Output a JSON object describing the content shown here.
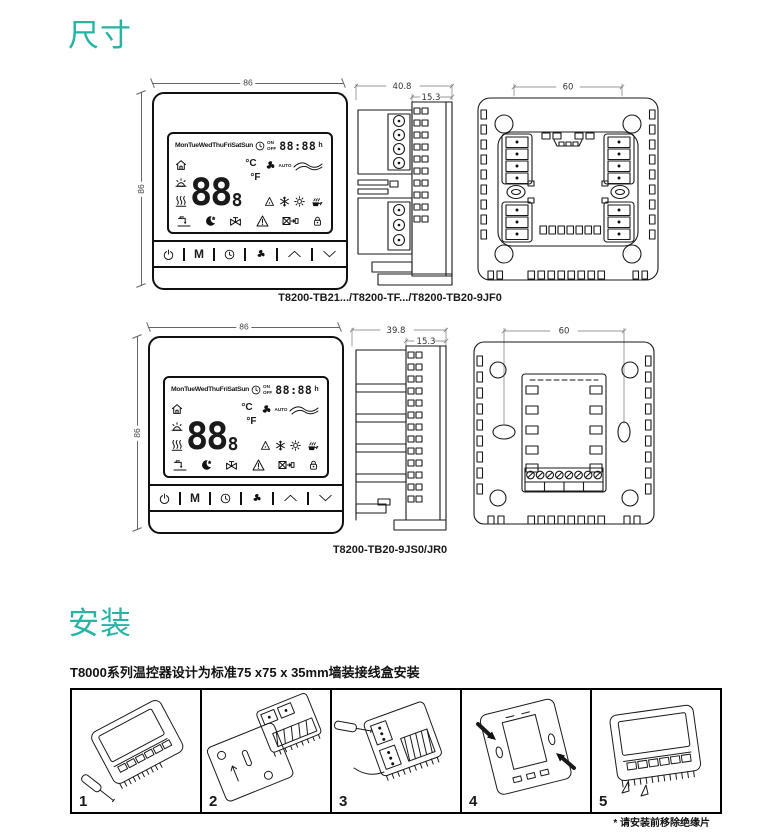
{
  "accent_color": "#26b5a3",
  "dimensions_section": {
    "title": "尺寸",
    "front_width_label": "86",
    "front_height_label": "86",
    "row1": {
      "side_depth": "40.8",
      "side_front_depth": "15.3",
      "back_hole_spacing": "60",
      "caption": "T8200-TB21.../T8200-TF.../T8200-TB20-9JF0"
    },
    "row2": {
      "side_depth": "39.8",
      "side_front_depth": "15.3",
      "back_hole_spacing": "60",
      "caption": "T8200-TB20-9JS0/JR0"
    }
  },
  "thermostat_lcd": {
    "days": "MonTueWedThuFriSatSun",
    "on": "ON",
    "off": "OFF",
    "time": "88:88",
    "time_unit": "h",
    "temp_main": "88",
    "temp_frac": "8",
    "celsius": "°C",
    "fahrenheit": "°F",
    "auto": "AUTO",
    "mode_button": "M",
    "status_icons": [
      "clock",
      "room",
      "outdoor-sun",
      "heating",
      "fan",
      "airflow",
      "cooling-triangle",
      "snowflake",
      "sun",
      "kettle-steam",
      "hot-water",
      "sleep-moon",
      "valve",
      "warning",
      "filter-clean",
      "keylock"
    ],
    "buttons": [
      "power",
      "M",
      "clock",
      "fan",
      "up",
      "down"
    ]
  },
  "installation_section": {
    "title": "安装",
    "description": "T8000系列温控器设计为标准75 x75 x 35mm墙装接线盒安装",
    "step_numbers": [
      "1",
      "2",
      "3",
      "4",
      "5"
    ],
    "footnote": "* 请安装前移除绝缘片"
  }
}
